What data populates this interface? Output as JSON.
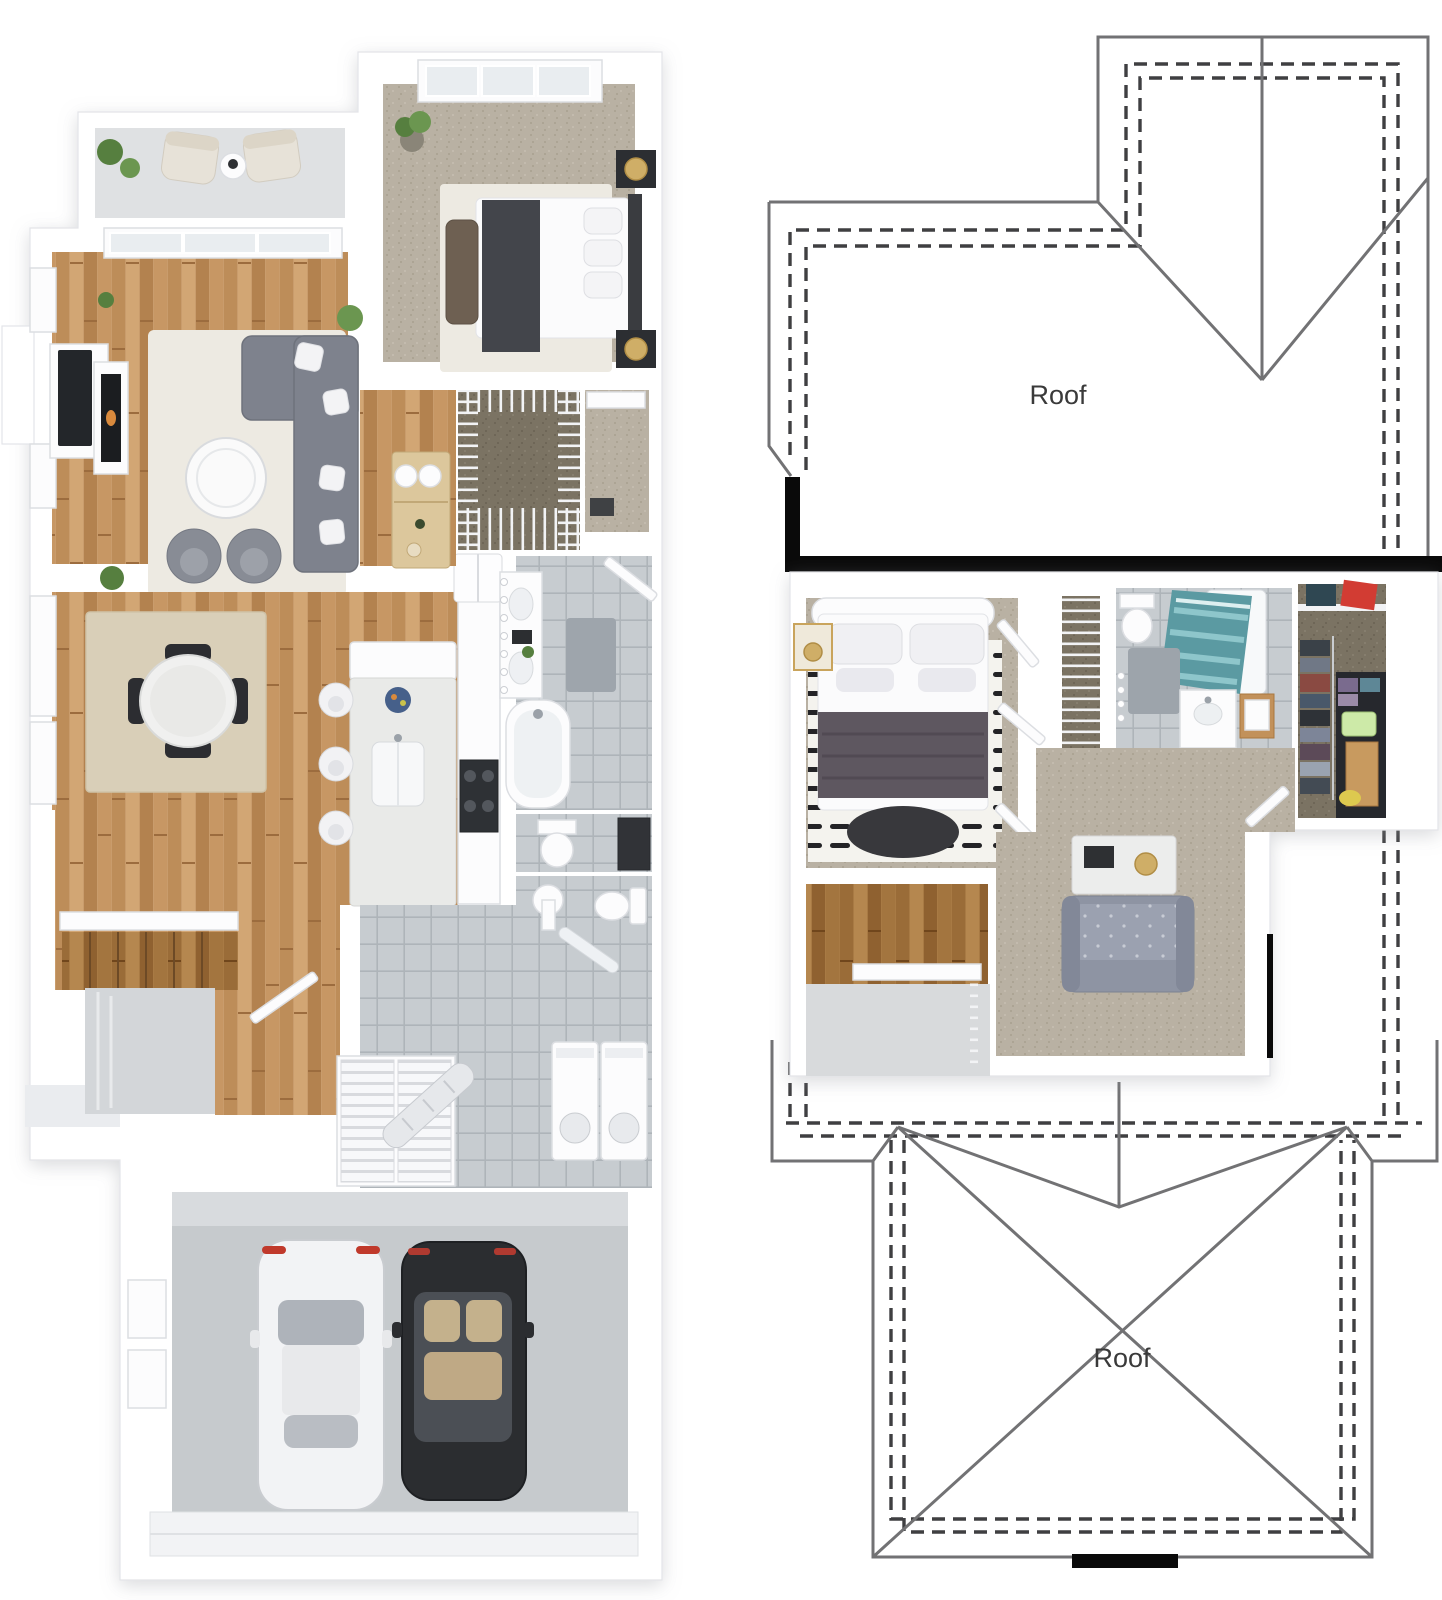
{
  "labels": {
    "upper_roof": "Roof",
    "lower_roof": "Roof"
  },
  "colors": {
    "wall": "#ffffff",
    "outline": "#e3e4e8",
    "roof_line": "#727274",
    "roof_dash": "#3f3f41",
    "black": "#0a0a0a",
    "text": "#3a3a3a",
    "wood": "#c99c6c",
    "wood_dark": "#a87a44",
    "carpet": "#b9b1a3",
    "carpet_dark": "#7b7363",
    "tile": "#c7ccd0",
    "concrete": "#c6cacd",
    "porch": "#d3d6d9",
    "balcony": "#dfe1e3",
    "rug_white": "#edeae2",
    "rug_beige": "#d9cfb8",
    "sofa": "#7e828d",
    "sofa_loft": "#8e94a3",
    "bed_throw_dark": "#43454b",
    "bed_blanket_mauve": "#5e5760",
    "ottoman": "#38383c",
    "shower_teal": "#5b9aa2",
    "gold": "#cfae67",
    "plant": "#567f3f",
    "accent_orange": "#d98a3d",
    "accent_red": "#d23c33",
    "accent_green": "#cdeaa8",
    "accent_yellow": "#ddc94f",
    "car_white": "#f2f3f5",
    "car_black": "#2b2d30"
  }
}
